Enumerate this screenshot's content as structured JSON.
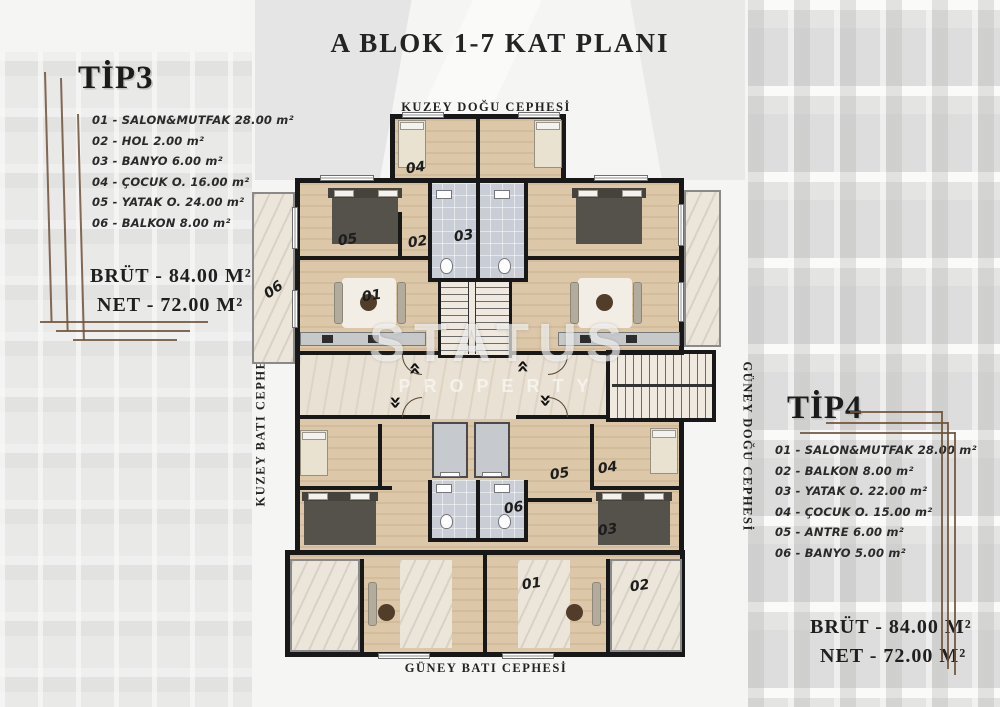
{
  "title": "A BLOK 1-7 KAT PLANI",
  "watermark": {
    "line1": "STATUS",
    "line2": "PROPERTY"
  },
  "facade_labels": {
    "top": "KUZEY DOĞU CEPHESİ",
    "bottom": "GÜNEY BATI CEPHESİ",
    "left": "KUZEY BATI CEPHESİ",
    "right": "GÜNEY DOĞU CEPHESİ"
  },
  "tip3": {
    "name": "TİP3",
    "items": [
      "01 - SALON&MUTFAK 28.00 m²",
      "02 - HOL 2.00 m²",
      "03 - BANYO 6.00 m²",
      "04 - ÇOCUK O. 16.00 m²",
      "05 - YATAK O. 24.00 m²",
      "06 - BALKON  8.00 m²"
    ],
    "brut": "BRÜT - 84.00 M²",
    "net": "NET - 72.00 M²"
  },
  "tip4": {
    "name": "TİP4",
    "items": [
      "01 - SALON&MUTFAK 28.00 m²",
      "02 - BALKON 8.00 m²",
      "03 - YATAK O. 22.00 m²",
      "04 - ÇOCUK O. 15.00 m²",
      "05 - ANTRE  6.00 m²",
      "06 - BANYO  5.00 m²"
    ],
    "brut": "BRÜT - 84.00 M²",
    "net": "NET - 72.00 M²"
  },
  "plan_room_numbers": {
    "tip3_unit": {
      "salon": "01",
      "hol": "02",
      "banyo": "03",
      "cocuk": "04",
      "yatak": "05",
      "balkon": "06"
    },
    "tip4_unit": {
      "salon": "01",
      "balkon": "02",
      "yatak": "03",
      "cocuk": "04",
      "antre": "05",
      "banyo": "06"
    }
  },
  "icons": {
    "double_chevron": "«"
  },
  "colors": {
    "wall": "#181818",
    "wood_floor": "#dcc7a8",
    "marble": "#ebe5da",
    "tile": "#c9ced6",
    "corridor": "#e9e1d3",
    "leader_line": "#6e5138"
  }
}
